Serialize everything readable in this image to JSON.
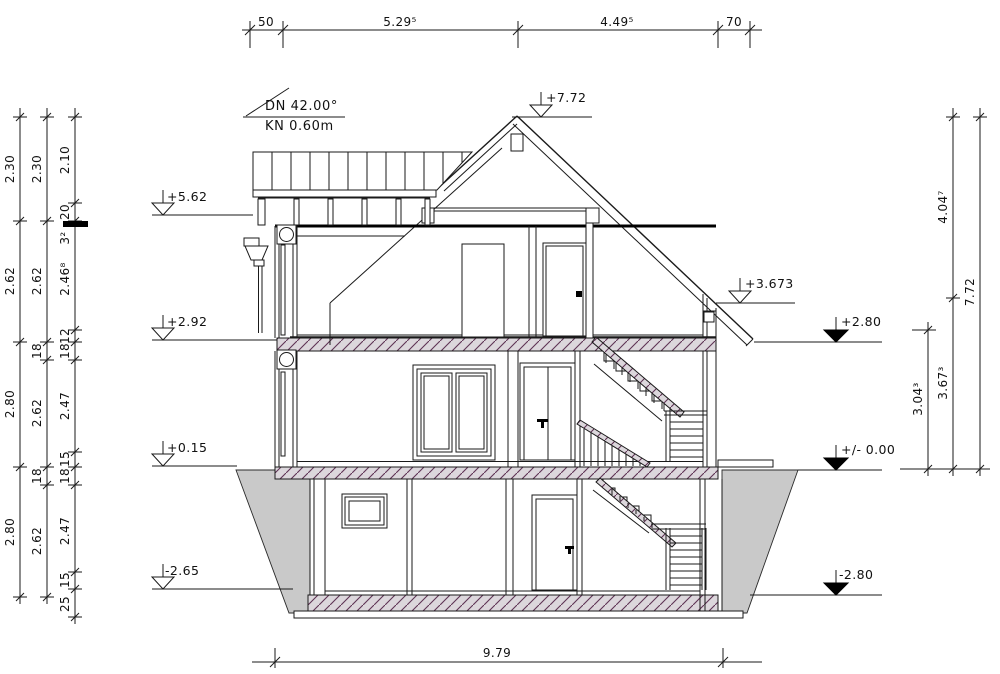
{
  "notes": {
    "roof_pitch": "DN 42.00°",
    "ridge_note": "KN 0.60m"
  },
  "levels": {
    "left": [
      "+5.62",
      "+2.92",
      "+0.15",
      "-2.65"
    ],
    "ridge": "+7.72",
    "eave": "+3.673",
    "right": [
      "+2.80",
      "+/- 0.00",
      "-2.80"
    ]
  },
  "dims": {
    "top": [
      "50",
      "5.29⁵",
      "4.49⁵",
      "70"
    ],
    "bottom": "9.79",
    "left_col1": [
      "2.30",
      "2.62",
      "2.80",
      "2.80"
    ],
    "left_col2": [
      "2.30",
      "2.62",
      "18",
      "2.62",
      "18",
      "2.62"
    ],
    "left_col3": [
      "2.10",
      "20",
      "3²",
      "2.46⁸",
      "12",
      "18",
      "2.47",
      "15",
      "18",
      "2.47",
      "15",
      "25"
    ],
    "right_inner": "3.04³",
    "right_mid": [
      "4.04⁷",
      "3.67³"
    ],
    "right_outer": "7.72"
  },
  "colors": {
    "line": "#1a1a1a",
    "earth_fill": "#c9c9c9",
    "slab_fill": "#dcd7dc",
    "hatch": "#5e3354"
  }
}
